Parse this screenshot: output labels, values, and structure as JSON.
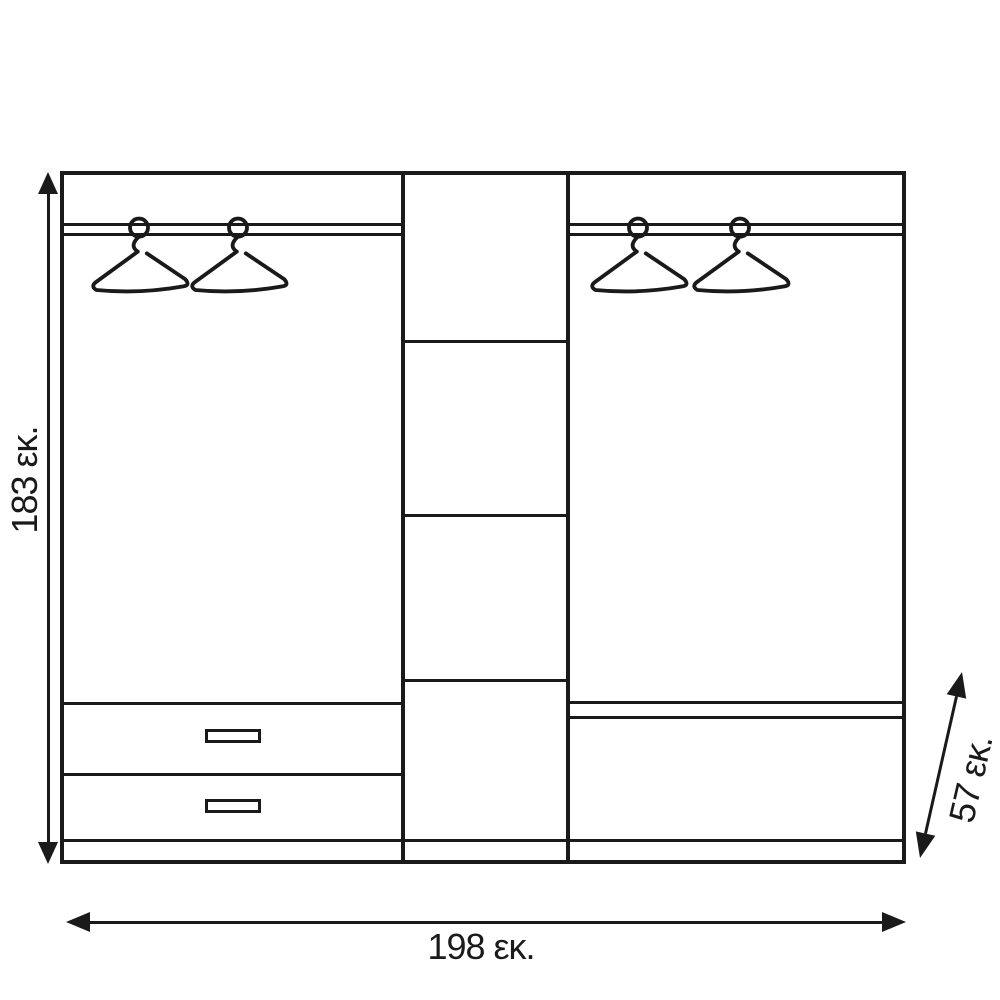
{
  "diagram": {
    "type": "furniture-dimension-drawing",
    "subject": "three-section wardrobe front elevation",
    "background_color": "#ffffff",
    "line_color": "#1a1a1a",
    "labels": {
      "height": "183 εκ.",
      "width": "198 εκ.",
      "depth": "57 εκ."
    },
    "structure": {
      "left_section": {
        "hanging_rail": true,
        "hangers": 2,
        "drawers": 2
      },
      "middle_section": {
        "compartments": 4
      },
      "right_section": {
        "hanging_rail": true,
        "hangers": 2,
        "shelves": 1
      }
    }
  }
}
